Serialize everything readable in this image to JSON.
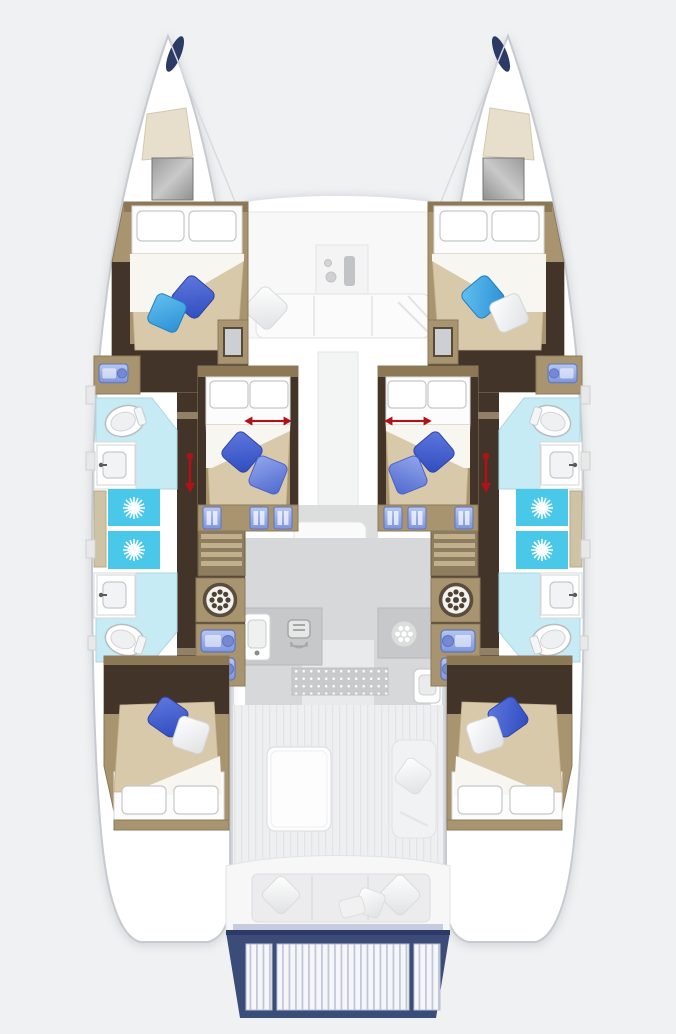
{
  "meta": {
    "description": "catamaran-yacht-floor-plan-top-view",
    "width_px": 676,
    "height_px": 1034
  },
  "colors": {
    "background": "#f0f1f2",
    "hull_white": "#ffffff",
    "outline": "#c7cad0",
    "deck_line": "#e2e3e6",
    "wood": "#a8946f",
    "wood_dark_trim": "#8d7856",
    "dark_walnut": "#43342a",
    "step_wood": "#8f7d5f",
    "step_slat": "#c2b08c",
    "bed_linen": "#fcfcfd",
    "pillow_outline": "#c6c7c9",
    "duvet_beige": "#d9c9ab",
    "fold_white": "#f8f6f1",
    "bath_floor": "#c7ebf5",
    "shower_cyan": "#49c8e9",
    "fixture_stroke": "#b9bcbe",
    "arrow_red": "#b11217",
    "navy_accent": "#2c3a66",
    "platform_navy": "#3c4c78",
    "galley_floor": "#d7d8d9",
    "counter_gray": "#c7c8ca",
    "cockpit_white": "#f8f8f9",
    "salon_floor": "#e9eaeb",
    "icon_gray": "#9aa0a3",
    "washer_ring": "#5b4d3e",
    "shelf_wood": "#cfc3a6",
    "pillow_royal_blue": "#3a5ecd",
    "pillow_royal_light": "#6f8ce0",
    "pillow_sky_blue": "#3fa9e4",
    "pillow_white": "#f1f2f3",
    "locker_blue": "#9db5ec"
  },
  "features": {
    "hulls": 2,
    "double_bed_cabins": 6,
    "forward_hull_cabins": 2,
    "aft_hull_cabins": 2,
    "central_cabins_with_width_arrow": 2,
    "bathrooms": 4,
    "toilets": 4,
    "sinks": 4,
    "shower_stalls": 4,
    "washing_machines": 2,
    "companionway_stairs": 2,
    "forward_cockpit_lounge": 1,
    "galley": 1,
    "cockpit_table": 1,
    "aft_bench": 1,
    "swim_platform_sections": 3,
    "deck_hatches": 2
  },
  "icons": [
    {
      "name": "toilet-icon",
      "shape": "oval-bowl"
    },
    {
      "name": "sink-icon",
      "shape": "rounded-basin-with-faucet"
    },
    {
      "name": "shower-drain-icon",
      "shape": "white-starburst"
    },
    {
      "name": "washing-machine-icon",
      "shape": "circle-with-dot-ring"
    },
    {
      "name": "stove-icon",
      "shape": "rounded-square-with-grill-lines"
    },
    {
      "name": "burner-icon",
      "shape": "circle-with-white-dots"
    },
    {
      "name": "bed-width-arrow-icon",
      "shape": "red-double-headed-arrow"
    },
    {
      "name": "companionway-arrow-icon",
      "shape": "red-arrow-with-dot"
    },
    {
      "name": "deck-hatch-icon",
      "shape": "gray-glass-square"
    }
  ]
}
